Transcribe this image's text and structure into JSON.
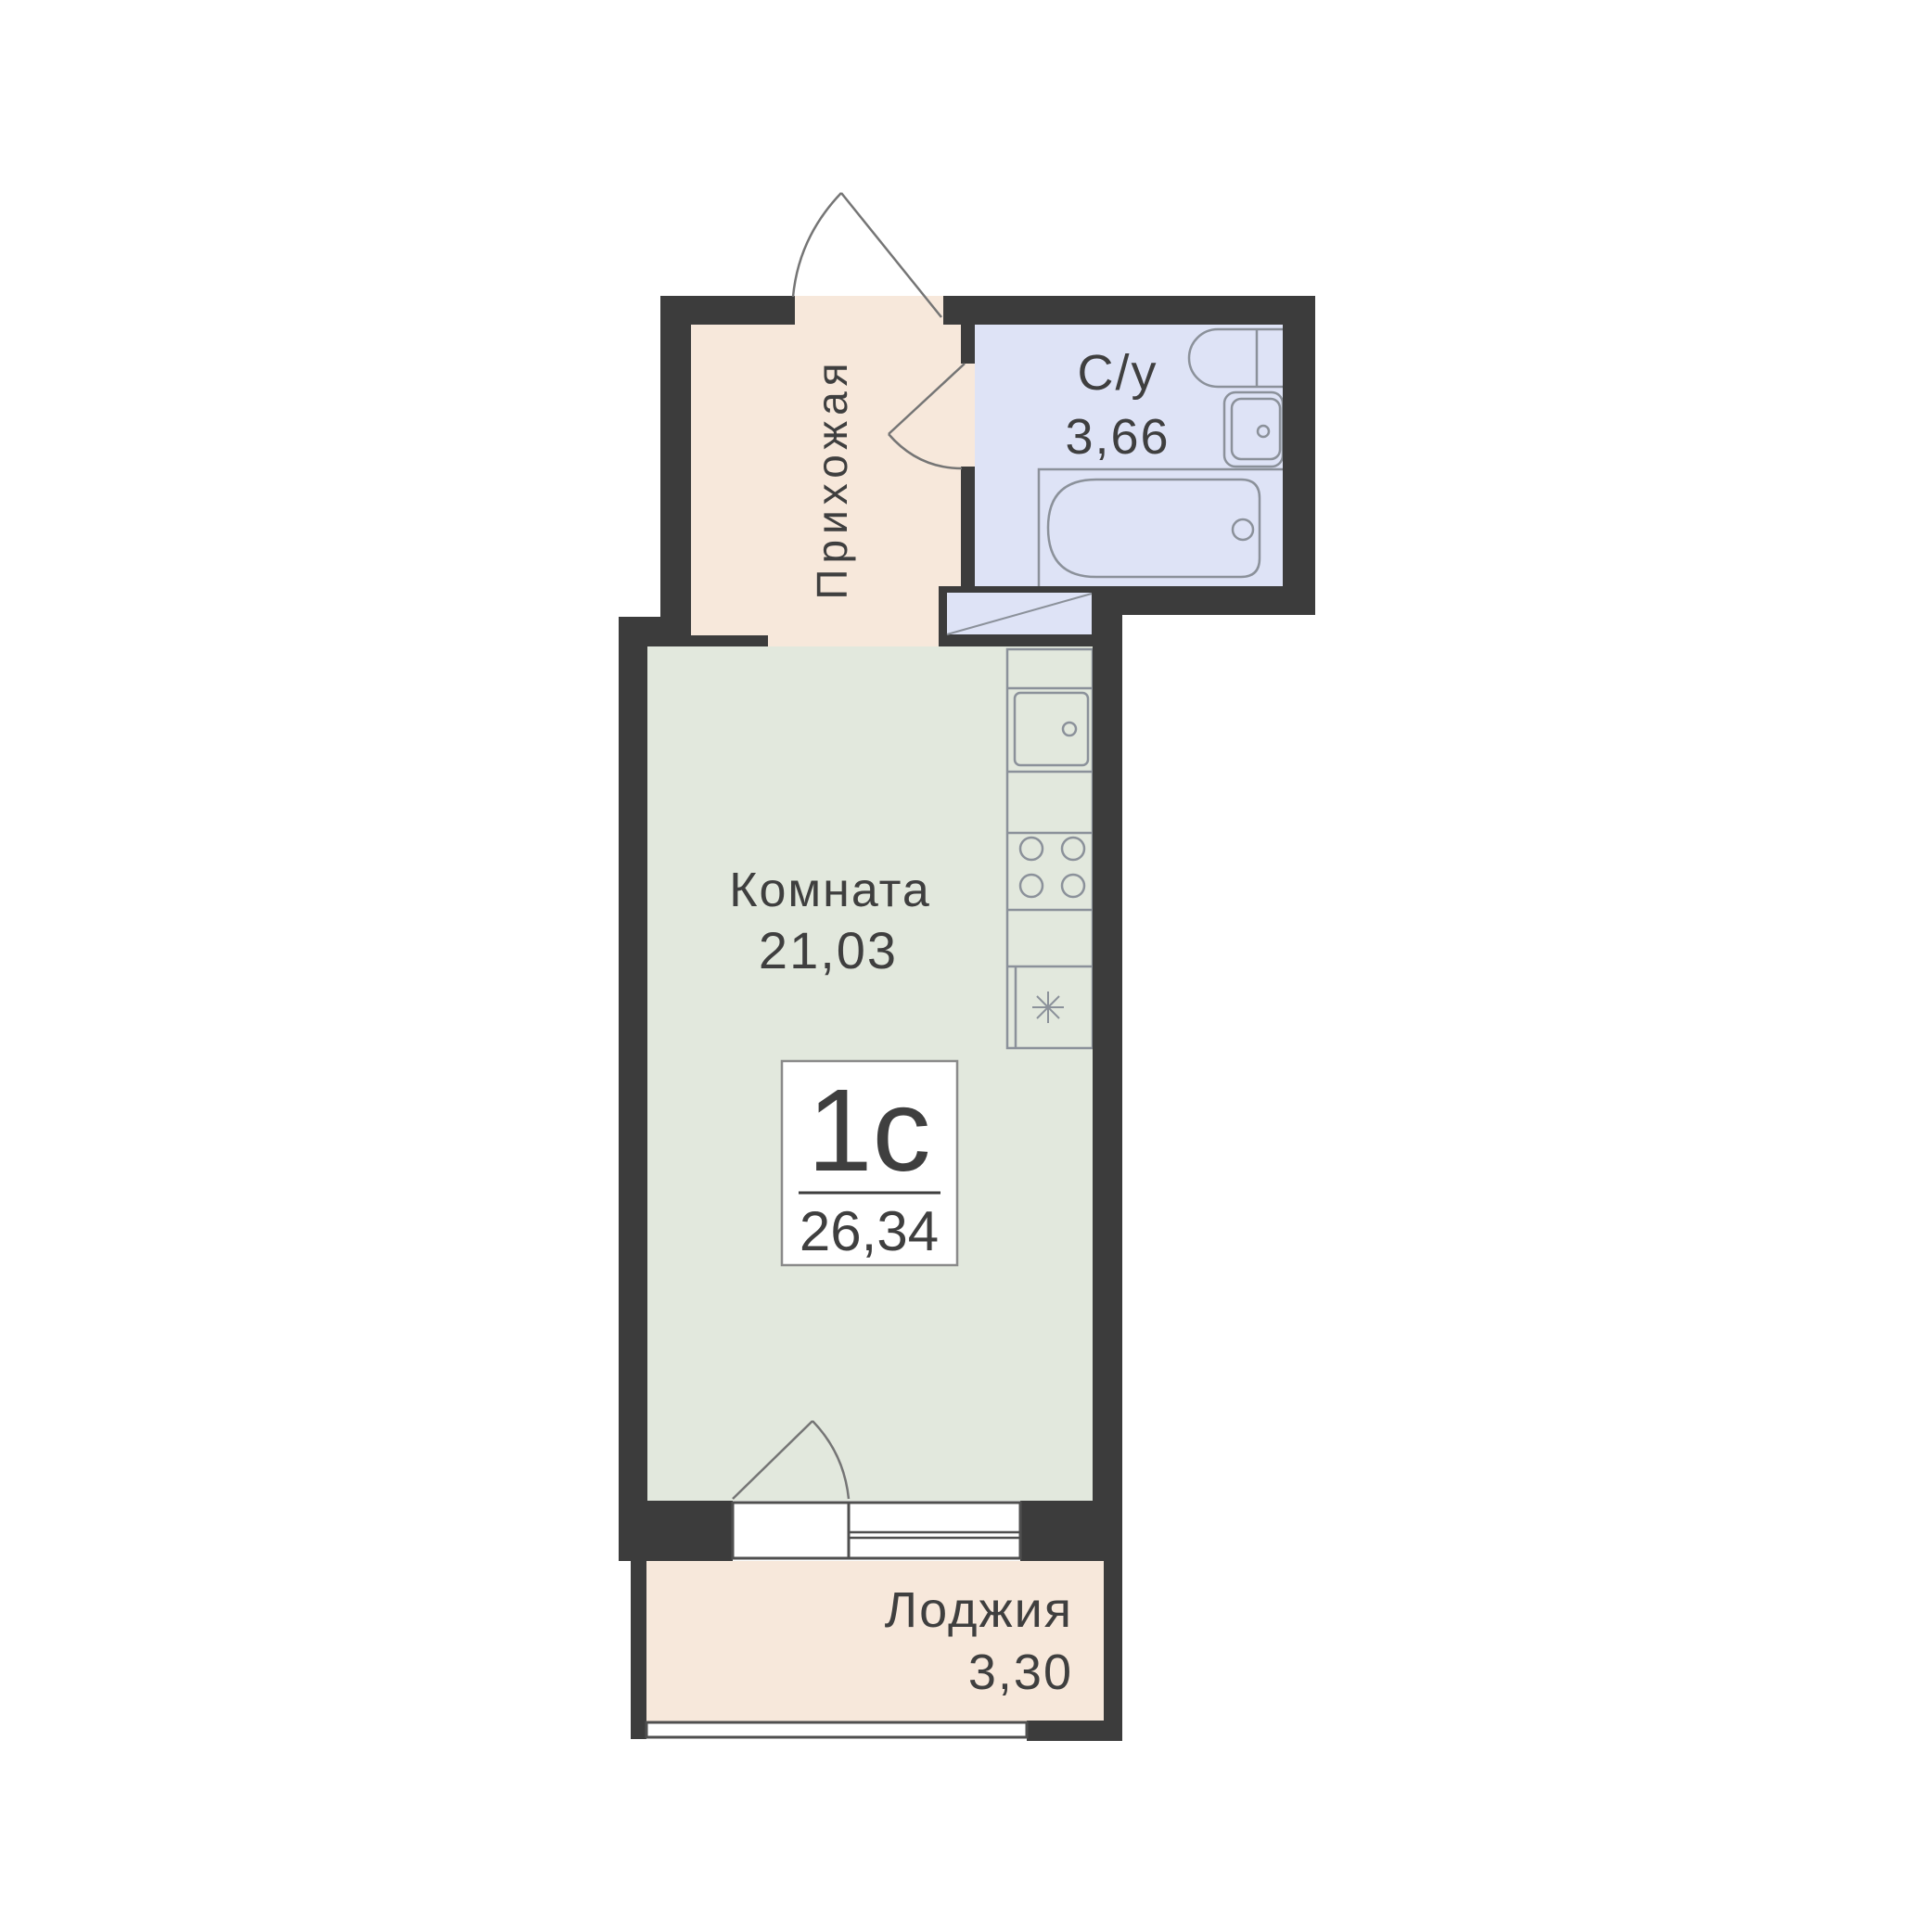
{
  "unit": {
    "type_label": "1с",
    "total_area": "26,34"
  },
  "rooms": {
    "hallway": {
      "label": "Прихожая"
    },
    "bathroom": {
      "label": "С/у",
      "area": "3,66"
    },
    "living": {
      "label": "Комната",
      "area": "21,03"
    },
    "loggia": {
      "label": "Лоджия",
      "area": "3,30"
    }
  },
  "colors": {
    "wall": "#3c3c3c",
    "hallway_fill": "#f7e8db",
    "bathroom_fill": "#dee3f6",
    "living_fill": "#e2e8dd",
    "loggia_fill": "#f7e8db",
    "shaft_fill": "#dee3f6",
    "fixture_stroke": "#8b919a",
    "door_stroke": "#757575",
    "window_stroke": "#4f4f4f",
    "text": "#3f3f3f",
    "badge_bg": "#ffffff"
  }
}
